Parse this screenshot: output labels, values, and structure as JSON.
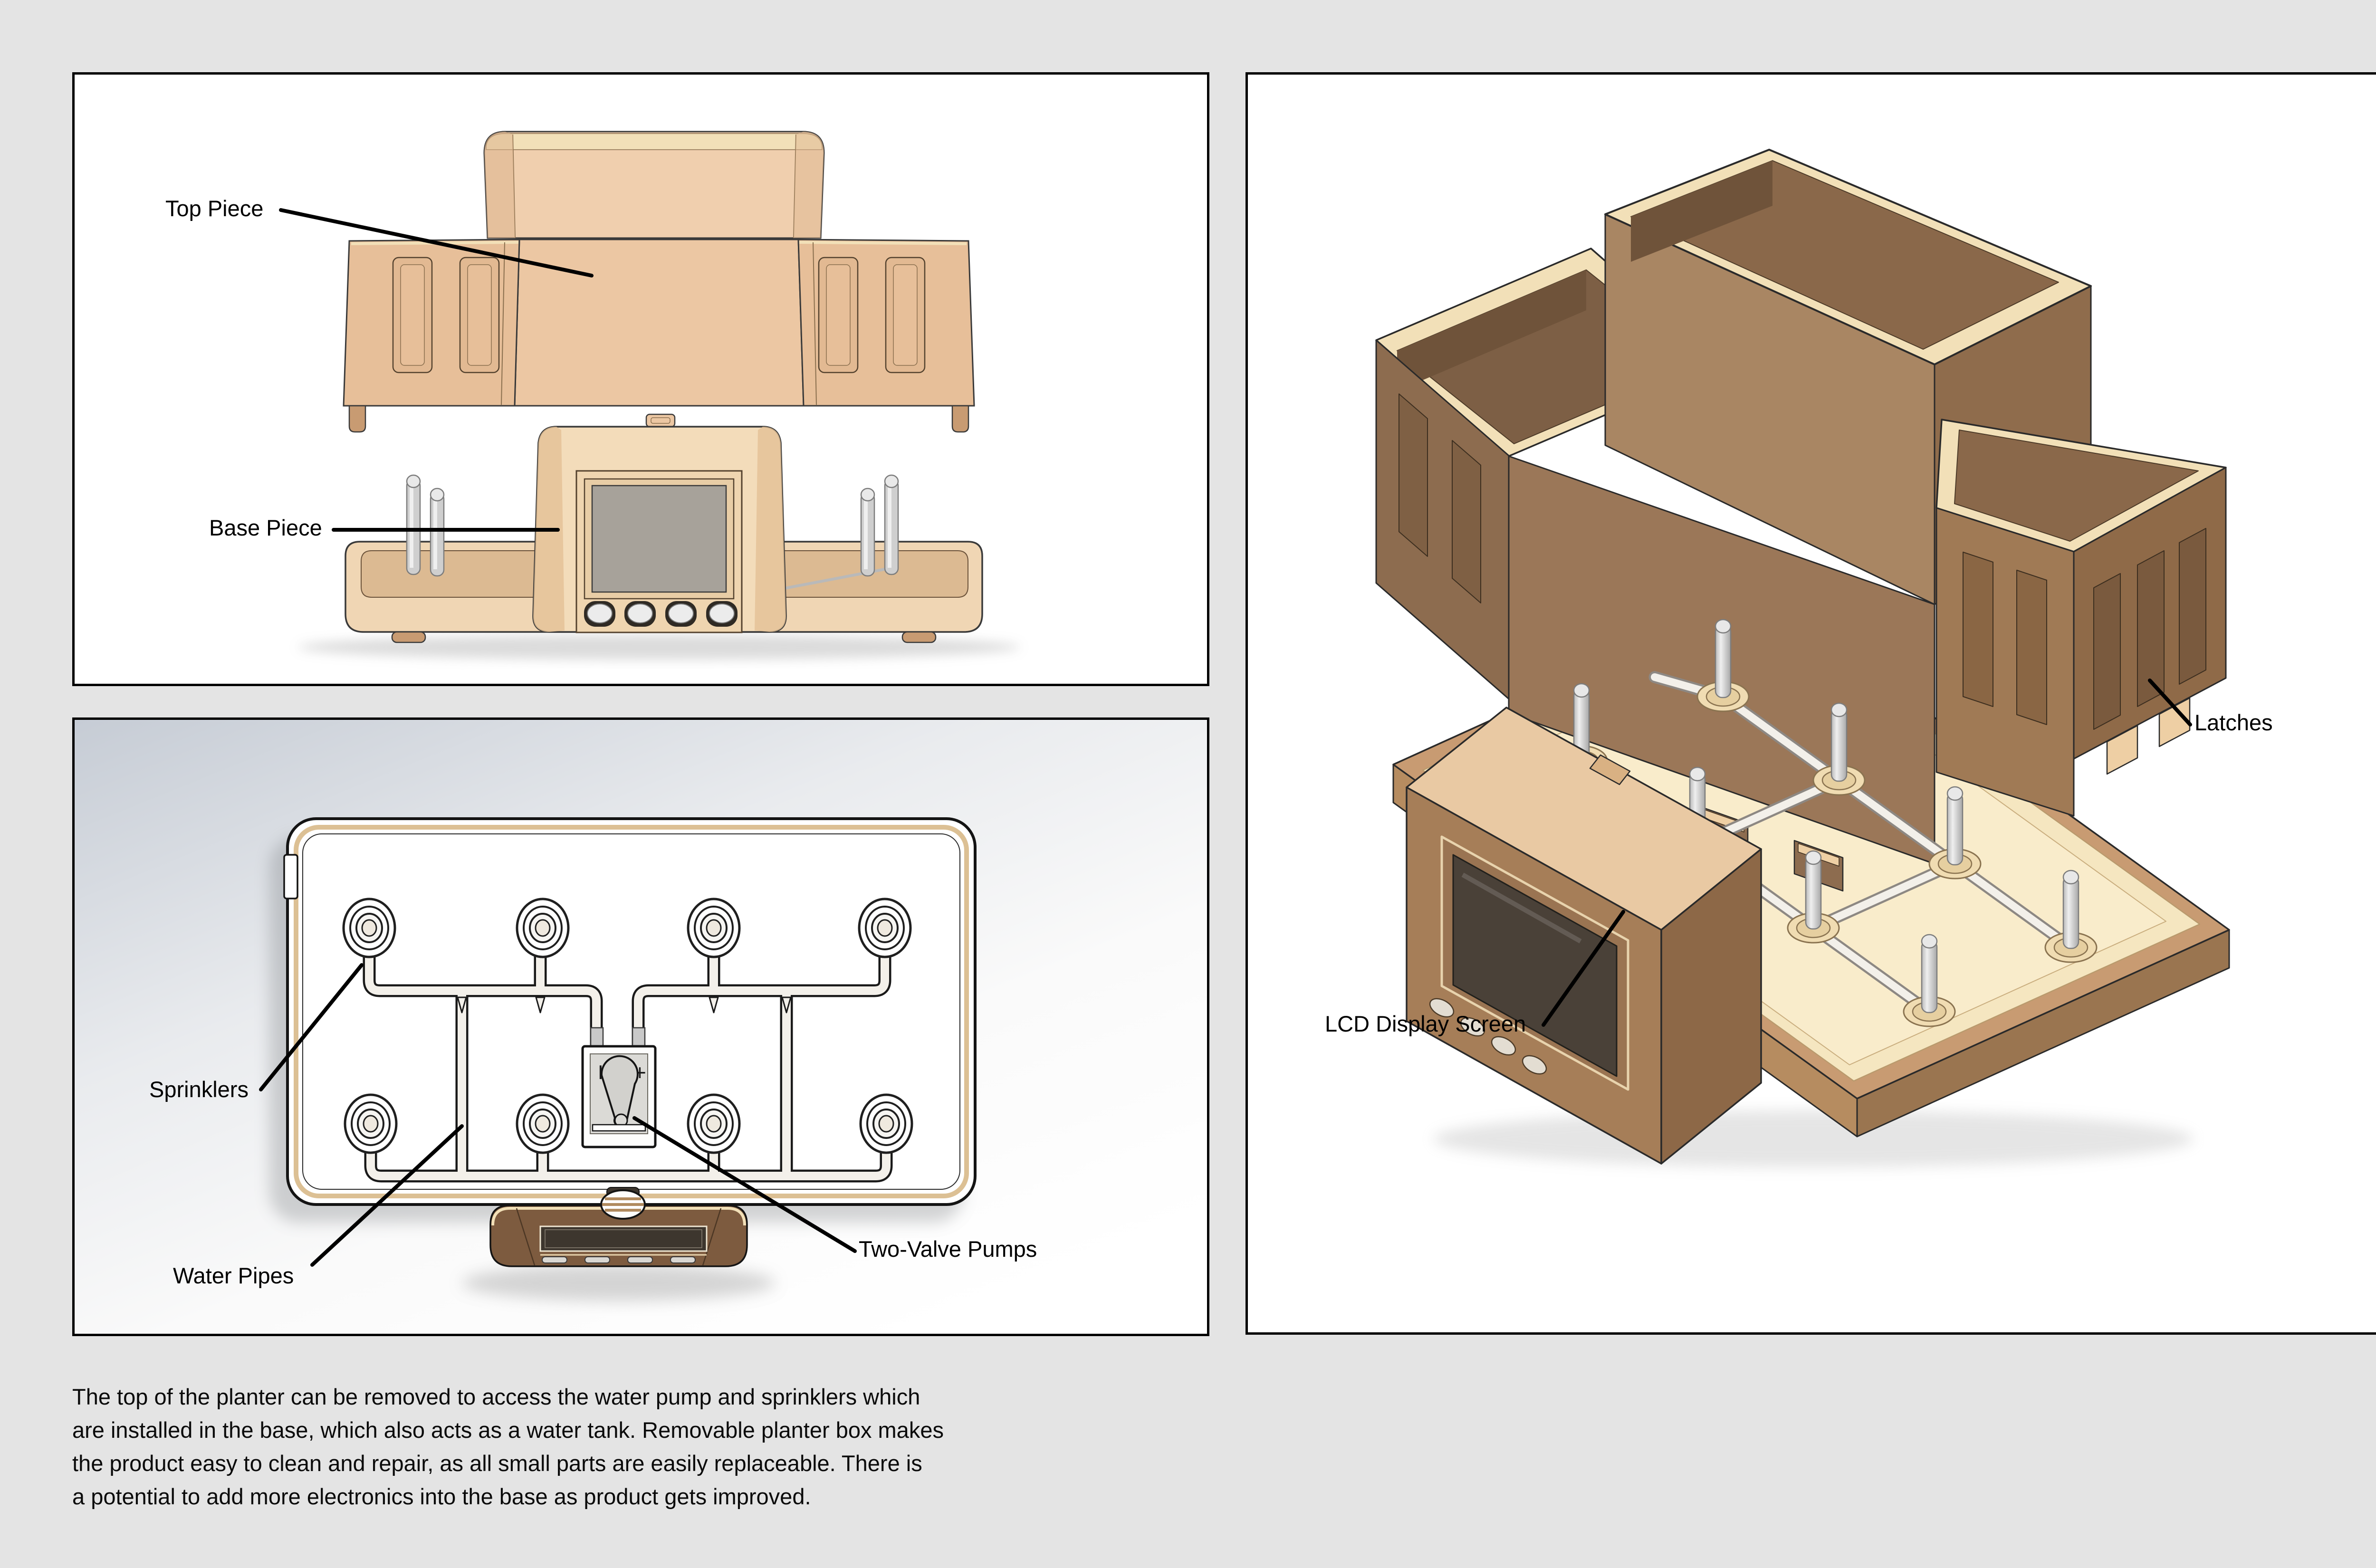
{
  "page": {
    "background": "#e4e4e4"
  },
  "description": {
    "lines": [
      "The top of the planter can be removed to access the water pump and sprinklers which",
      "are installed in the base, which also acts as a water tank. Removable planter box makes",
      "the product easy to clean and repair, as all small parts are easily replaceable. There is",
      "a potential to add more electronics into the base as product gets improved."
    ]
  },
  "panels": {
    "front_view": {
      "labels": {
        "top_piece": "Top Piece",
        "base_piece": "Base Piece"
      }
    },
    "top_view": {
      "labels": {
        "sprinklers": "Sprinklers",
        "water_pipes": "Water Pipes",
        "two_valve_pumps": "Two-Valve Pumps"
      },
      "pump": {
        "left_mark": "I",
        "right_mark": "+"
      }
    },
    "iso_view": {
      "labels": {
        "latches": "Latches",
        "lcd_display": "LCD Display Screen"
      }
    }
  },
  "colors": {
    "page_bg": "#e4e4e4",
    "tan_face": "#ecc7a3",
    "tan_soft": "#f0cfae",
    "tan_mid": "#e7bf99",
    "tan_deep": "#c89b72",
    "cream_rim": "#f2e0b8",
    "cream_floor": "#f5e6c0",
    "unit_cream": "#f3dcba",
    "brown_wall": "#9b7758",
    "brown_wall_dark": "#8a6647",
    "brown_int": "#7d5f45",
    "brown_unit": "#7d5b3f",
    "unit_face": "#a67e58",
    "unit_side": "#8d6847",
    "unit_top": "#e9c9a3",
    "screen_gray": "#a7a29a",
    "screen_dark": "#4a4138",
    "pin_gray": "#cfcfcf",
    "pipe_fill": "#f3f0ea",
    "ring_gold": "#dcc094",
    "grad_top": "#c6ccd5"
  }
}
